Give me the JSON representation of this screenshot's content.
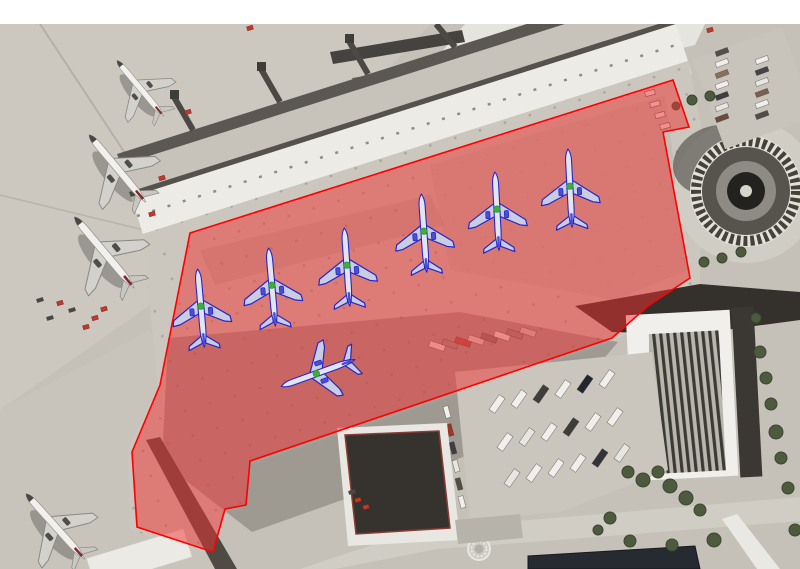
{
  "frame": {
    "width": 800,
    "height": 569,
    "top_margin_px": 24,
    "margin_color": "#ffffff"
  },
  "annotation": {
    "zone": {
      "label": "highlighted-apron-zone",
      "fill": "#f03030",
      "fill_opacity": 0.5,
      "stroke": "#ff0000",
      "stroke_width": 1.6,
      "points": [
        [
          190,
          233
        ],
        [
          673,
          80
        ],
        [
          689,
          127
        ],
        [
          663,
          132
        ],
        [
          690,
          278
        ],
        [
          648,
          306
        ],
        [
          612,
          338
        ],
        [
          250,
          461
        ],
        [
          246,
          505
        ],
        [
          225,
          509
        ],
        [
          213,
          552
        ],
        [
          137,
          527
        ],
        [
          132,
          452
        ],
        [
          160,
          385
        ]
      ]
    },
    "plane_style": {
      "outline": "#2626c8",
      "body_fill": "#e2e4ef",
      "wing_fill": "#c9cde4",
      "engine_fill": "#4d4dd2",
      "marker_fill": "#3cae3c",
      "scale": 0.6
    },
    "planes": [
      {
        "x": 201,
        "y": 308,
        "rot": -5
      },
      {
        "x": 272,
        "y": 287,
        "rot": -5
      },
      {
        "x": 347,
        "y": 267,
        "rot": -4
      },
      {
        "x": 424,
        "y": 233,
        "rot": -4
      },
      {
        "x": 497,
        "y": 211,
        "rot": -3
      },
      {
        "x": 570,
        "y": 188,
        "rot": -3
      },
      {
        "x": 318,
        "y": 373,
        "rot": 250
      }
    ]
  },
  "photo_planes": [
    {
      "x": 140,
      "y": 88,
      "rot": -40,
      "s": 0.58
    },
    {
      "x": 117,
      "y": 168,
      "rot": -40,
      "s": 0.7
    },
    {
      "x": 104,
      "y": 252,
      "rot": -40,
      "s": 0.74
    },
    {
      "x": 55,
      "y": 526,
      "rot": -42,
      "s": 0.7
    }
  ],
  "scenery": {
    "trees": [
      [
        628,
        472,
        6
      ],
      [
        643,
        480,
        7
      ],
      [
        658,
        472,
        6
      ],
      [
        670,
        486,
        7
      ],
      [
        686,
        498,
        7
      ],
      [
        700,
        510,
        6
      ],
      [
        714,
        540,
        7
      ],
      [
        610,
        518,
        6
      ],
      [
        598,
        530,
        5
      ],
      [
        630,
        541,
        6
      ],
      [
        672,
        545,
        6
      ],
      [
        760,
        352,
        6
      ],
      [
        766,
        378,
        6
      ],
      [
        771,
        404,
        6
      ],
      [
        776,
        432,
        7
      ],
      [
        781,
        458,
        6
      ],
      [
        788,
        488,
        6
      ],
      [
        756,
        318,
        5
      ],
      [
        741,
        252,
        5
      ],
      [
        722,
        258,
        5
      ],
      [
        704,
        262,
        5
      ],
      [
        692,
        100,
        5
      ],
      [
        710,
        96,
        5
      ],
      [
        676,
        106,
        4
      ],
      [
        795,
        530,
        6
      ]
    ],
    "red_vehicles": [
      [
        250,
        28
      ],
      [
        188,
        112
      ],
      [
        162,
        178
      ],
      [
        152,
        214
      ],
      [
        95,
        318
      ],
      [
        86,
        327
      ],
      [
        60,
        303
      ],
      [
        104,
        309
      ],
      [
        710,
        30
      ],
      [
        358,
        500
      ],
      [
        366,
        507
      ]
    ],
    "dark_vans": [
      [
        72,
        310
      ],
      [
        50,
        318
      ],
      [
        40,
        300
      ],
      [
        352,
        492
      ]
    ],
    "ramp_trucks": [
      [
        650,
        93
      ],
      [
        655,
        104
      ],
      [
        660,
        115
      ],
      [
        665,
        126
      ]
    ],
    "dock_truck_row": {
      "x0": 437,
      "y0": 346,
      "dx": 13,
      "dy": -2,
      "n": 8,
      "rot": -72,
      "w": 6,
      "h": 16,
      "fills": [
        "#e9e7e1",
        "#98948e",
        "#b0534e",
        "#d9d6cf",
        "#7d7a74",
        "#e9e7e1",
        "#8f8c86",
        "#ccc9c2"
      ]
    },
    "trailer_rows": [
      {
        "x0": 497,
        "y0": 404,
        "dx": 22,
        "dy": -5,
        "n": 6,
        "rot": -55,
        "w": 18,
        "h": 7,
        "fills": [
          "#f0efeb",
          "#f0efeb",
          "#403e3a",
          "#f0efeb",
          "#23262c",
          "#f0efeb"
        ]
      },
      {
        "x0": 505,
        "y0": 442,
        "dx": 22,
        "dy": -5,
        "n": 6,
        "rot": -55,
        "w": 18,
        "h": 7,
        "fills": [
          "#f0efeb",
          "#e8e6e0",
          "#f0efeb",
          "#3f3d38",
          "#f0efeb",
          "#f0efeb"
        ]
      },
      {
        "x0": 512,
        "y0": 478,
        "dx": 22,
        "dy": -5,
        "n": 6,
        "rot": -55,
        "w": 18,
        "h": 7,
        "fills": [
          "#e8e6e0",
          "#f0efeb",
          "#f0efeb",
          "#f0efeb",
          "#35333a",
          "#e8e6e0"
        ]
      }
    ],
    "car_rows": [
      {
        "x0": 722,
        "y0": 52,
        "dx": 0,
        "dy": 11,
        "n": 7,
        "rot": -20,
        "w": 13,
        "h": 5,
        "fills": [
          "#53504a",
          "#f0efeb",
          "#8a6f5f",
          "#f0efeb",
          "#3f3d44",
          "#e8e6e0",
          "#6b4a3f"
        ]
      },
      {
        "x0": 762,
        "y0": 60,
        "dx": 0,
        "dy": 11,
        "n": 6,
        "rot": -20,
        "w": 13,
        "h": 5,
        "fills": [
          "#f0efeb",
          "#45424a",
          "#e8e6e0",
          "#7a5f52",
          "#f0efeb",
          "#514e48"
        ]
      },
      {
        "x0": 447,
        "y0": 412,
        "dx": 3,
        "dy": 18,
        "n": 6,
        "rot": 75,
        "w": 12,
        "h": 5,
        "fills": [
          "#f0efeb",
          "#a03428",
          "#3f3d44",
          "#e8e6e0",
          "#514e48",
          "#f0efeb"
        ]
      }
    ]
  },
  "palette": {
    "apron_base": "#c5c1b9",
    "apron_light": "#ccc8c0",
    "roof_light": "#edebe6",
    "roof_mid": "#cbc7bf",
    "shadow_dark": "#34312c",
    "tree_green": "#4e5a3e",
    "road": "#d0cdc5",
    "building_dark": "#36332e",
    "building_red_trim": "#8c3b34"
  }
}
